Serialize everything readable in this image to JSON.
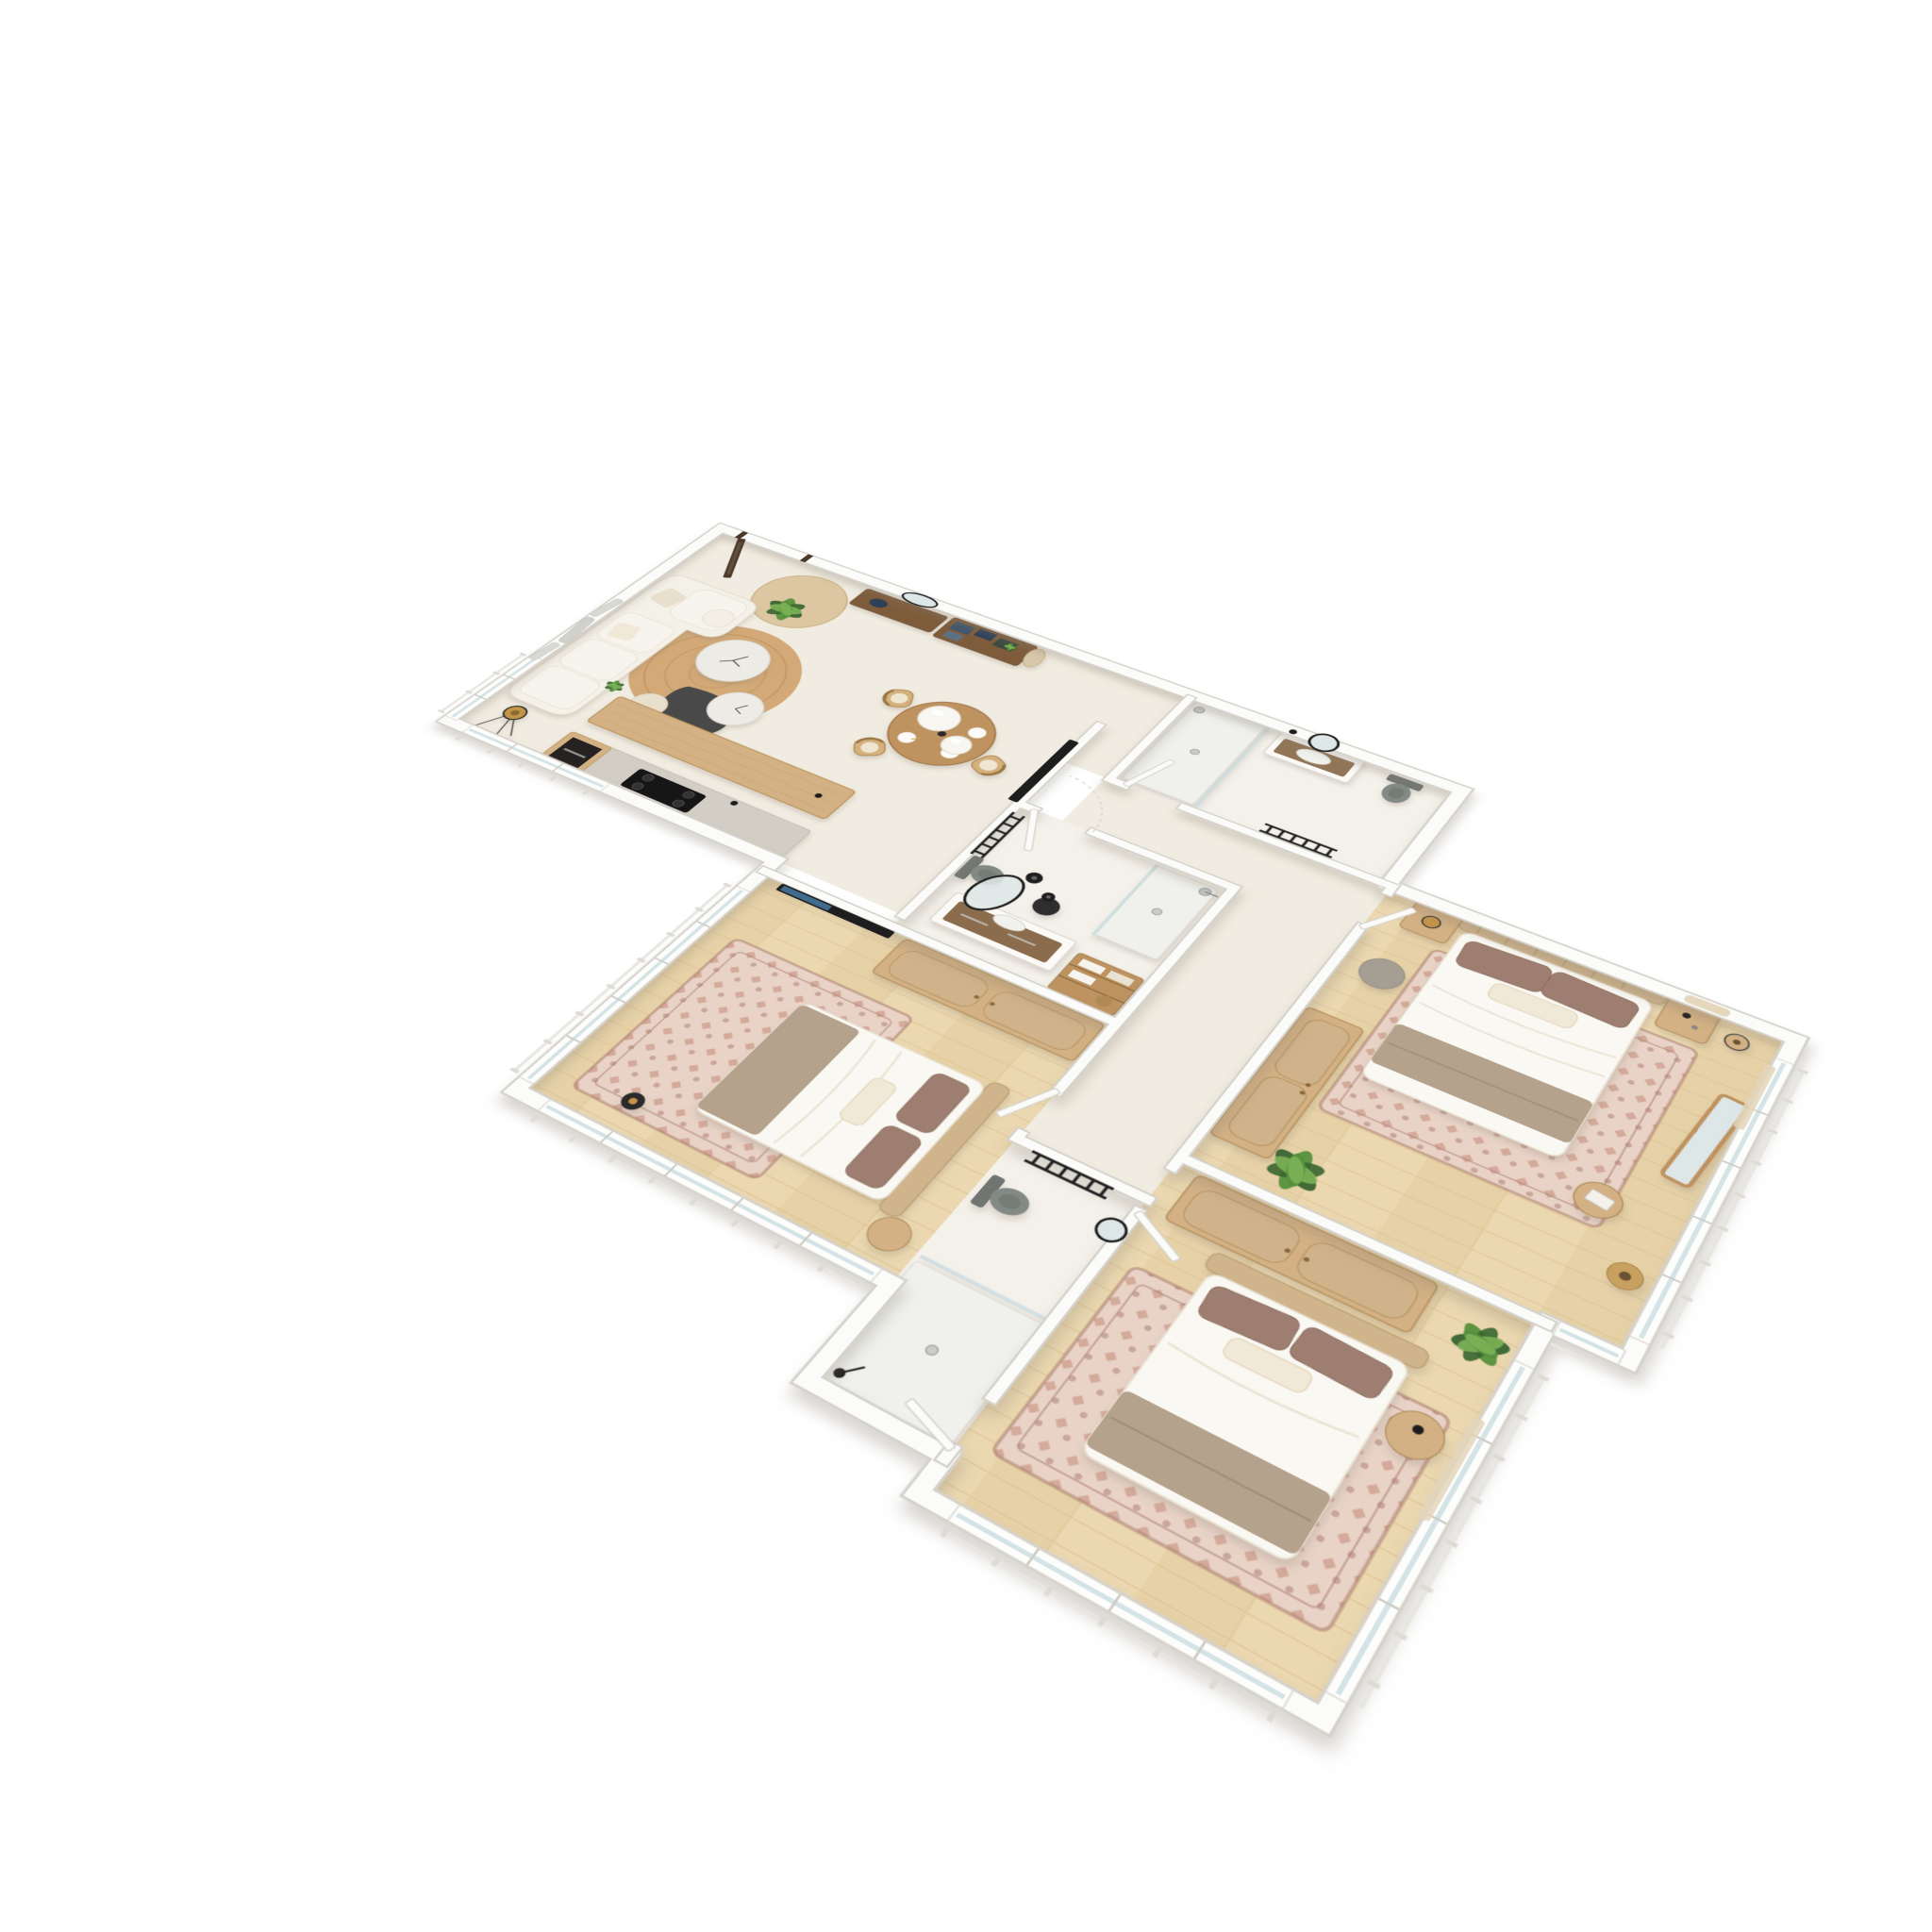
{
  "scene": {
    "type": "3d-floor-plan-render",
    "style": "tilted top-down axonometric, photoreal furniture, pure white background, no text or labels",
    "view": {
      "rotation_deg": 33,
      "tilt_deg": 55
    },
    "background": "#ffffff"
  },
  "colors": {
    "wall": "#fbfbf9",
    "wall_edge": "#d5d2cb",
    "floor_cream": "#f1ece1",
    "floor_bath": "#f4f1ea",
    "floor_wood": "#ebd8b0",
    "floor_wood2": "#e4cda0",
    "floor_wood_line": "#d6bc8d",
    "wood": "#d3b184",
    "wood_mid": "#bf9360",
    "wood_dark": "#7e5c3b",
    "counter_gray": "#d2cec5",
    "sofa": "#f4f1e9",
    "cushion": "#e8dfcc",
    "rug_jute": "#d2a977",
    "rug_jute_ring": "#bf9260",
    "rug_pink_light": "#e8d3c6",
    "rug_pink": "#cfa090",
    "rug_pink_dark": "#a97a6c",
    "bed_white": "#faf8f2",
    "blanket_taupe": "#b4a28c",
    "pillow_brown": "#9e7e70",
    "pillow_cream": "#f1e9d7",
    "cane": "#cfb48c",
    "plant_dark": "#39642f",
    "plant_mid": "#55913c",
    "plant_light": "#7cb258",
    "black": "#1e1e1e",
    "charcoal": "#4a4a48",
    "fixture_gray": "#838984",
    "chrome": "#c0c4c5",
    "glass": "#c9dcde",
    "marble": "#edebe5",
    "mirror": "#dde7e8",
    "navy": "#41566c",
    "navy_dark": "#2f4154",
    "teal_dark": "#3a4a40",
    "lamp_gold": "#c39449",
    "silver": "#d8d8d2",
    "curtain": "#e3d5ba"
  },
  "apartment": {
    "rooms": [
      {
        "id": "living-dining",
        "floor": "cream",
        "items": [
          "entry-door",
          "entry-round-rug",
          "entry-wall-mirror",
          "console-bench",
          "shelf-unit",
          "storage-boxes-navy",
          "hanging-coat",
          "sofa-l-shape",
          "throw-pillows",
          "silver-wall-art",
          "potted-plant",
          "round-jute-rug",
          "marble-coffee-table-large",
          "marble-coffee-table-small",
          "charcoal-coffee-table",
          "cream-pouf",
          "tripod-floor-lamp",
          "round-dining-table",
          "cane-dining-chairs-x3",
          "place-settings-x4",
          "white-sphere-pendants-x2",
          "wall-tv"
        ]
      },
      {
        "id": "kitchen",
        "floor": "cream",
        "items": [
          "wood-island-counter",
          "gray-top-counter",
          "induction-cooktop",
          "built-in-oven-tower",
          "small-green-plant",
          "faucet"
        ]
      },
      {
        "id": "hallway",
        "floor": "cream",
        "items": [
          "door-leaves-ajar"
        ]
      },
      {
        "id": "bathroom-main",
        "floor": "stone",
        "items": [
          "vanity-with-sink",
          "oval-leaning-mirror",
          "black-stool",
          "black-pendant-lamps-x2",
          "wall-hung-toilet",
          "black-towel-radiator",
          "walk-in-shower",
          "glass-screen",
          "chrome-shower-head",
          "wood-towel-shelf"
        ]
      },
      {
        "id": "bathroom-ensuite-top",
        "floor": "stone",
        "items": [
          "walk-in-shower",
          "glass-screen",
          "chrome-shower-head",
          "vanity-with-sink",
          "round-black-mirror",
          "black-wall-lamp",
          "wall-hung-toilet",
          "black-towel-radiator"
        ]
      },
      {
        "id": "bedroom-master",
        "floor": "oak",
        "items": [
          "double-bed",
          "cane-headboard",
          "brown-pillows-x2",
          "cream-lumbar-pillow",
          "taupe-blanket",
          "area-rug-oriental",
          "nightstands-x2",
          "table-lamp",
          "wood-floor-lamp",
          "gray-pouf",
          "wardrobe",
          "leaning-floor-mirror",
          "side-stool-with-vases",
          "wicker-gourd-vase",
          "fiddle-leaf-plant",
          "macrame-wall-hanging",
          "sheer-curtain"
        ]
      },
      {
        "id": "bedroom-second",
        "floor": "oak",
        "items": [
          "double-bed",
          "cane-headboard",
          "brown-pillows-x2",
          "cream-pillow",
          "taupe-blanket",
          "area-rug-oriental",
          "wardrobe-cane-doors",
          "wall-tv",
          "black-floor-lamp",
          "round-nightstand"
        ]
      },
      {
        "id": "bedroom-third",
        "floor": "oak",
        "items": [
          "double-bed",
          "cane-headboard",
          "brown-pillows-x2",
          "cream-pillow",
          "taupe-blanket",
          "area-rug-oriental",
          "wardrobe-cane-doors",
          "round-side-table",
          "fan-palm-plant",
          "sheer-curtain"
        ]
      },
      {
        "id": "bathroom-small",
        "floor": "stone",
        "items": [
          "wall-hung-toilet",
          "black-towel-radiator",
          "round-black-mirror",
          "walk-in-shower",
          "glass-screen",
          "black-shower-set"
        ]
      }
    ],
    "windows": [
      "living-west",
      "kitchen-south",
      "bedroom-second-west",
      "bedroom-second-south",
      "bedroom-third-south",
      "bedroom-third-east",
      "bedroom-master-east",
      "bedroom-master-south-step"
    ],
    "doors": [
      "entry-dark-frame",
      "bathroom-main",
      "bathroom-ensuite-top",
      "bedroom-master",
      "bedroom-second",
      "bedroom-third",
      "bathroom-small"
    ]
  }
}
